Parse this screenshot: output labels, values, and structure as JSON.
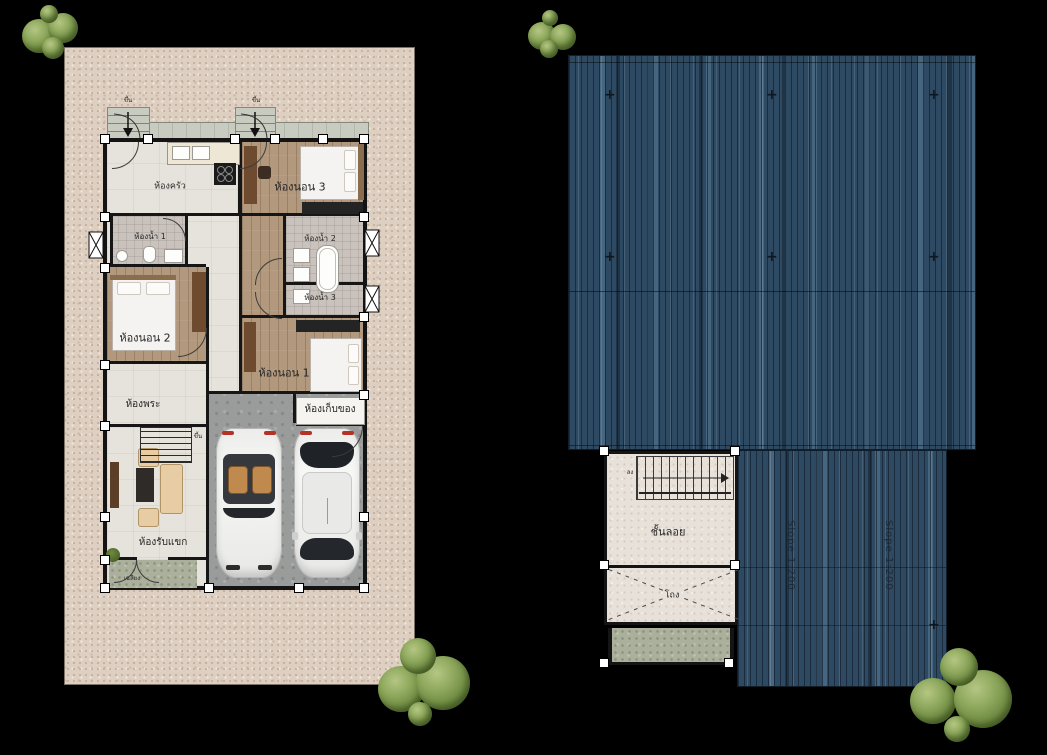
{
  "scene": {
    "type": "architectural drawing sheet",
    "left_view": "ground floor plan on land plot",
    "right_view": "roof plan with mezzanine"
  },
  "floor_plan": {
    "labels": {
      "kitchen": "ห้องครัว",
      "bedroom3": "ห้องนอน 3",
      "bath1": "ห้องน้ำ 1",
      "bath2": "ห้องน้ำ 2",
      "bath3": "ห้องน้ำ 3",
      "bedroom2": "ห้องนอน 2",
      "bedroom1": "ห้องนอน 1",
      "prayer": "ห้องพระ",
      "storage": "ห้องเก็บของ",
      "living": "ห้องรับแขก",
      "porch": "เฉลียง"
    },
    "stair_up": "ขึ้น"
  },
  "roof_plan": {
    "mezzanine": "ชั้นลอย",
    "hall": "โถง",
    "slope": "Slope 1:200",
    "stair_down": "ลง",
    "register_mark": "+"
  },
  "colors": {
    "background": "#000000",
    "roof_metal": "#2e4a62",
    "land": "#ddcfc1",
    "wall": "#161616",
    "wood_floor": "#b2987c",
    "tile_floor": "#e6e2dc",
    "bath_tile": "#cac3bd",
    "garage_concrete": "#9a9c9b",
    "walkway": "#c8cbc0",
    "porch_green": "#aab09b",
    "tree_green": "#7d9a4c"
  }
}
